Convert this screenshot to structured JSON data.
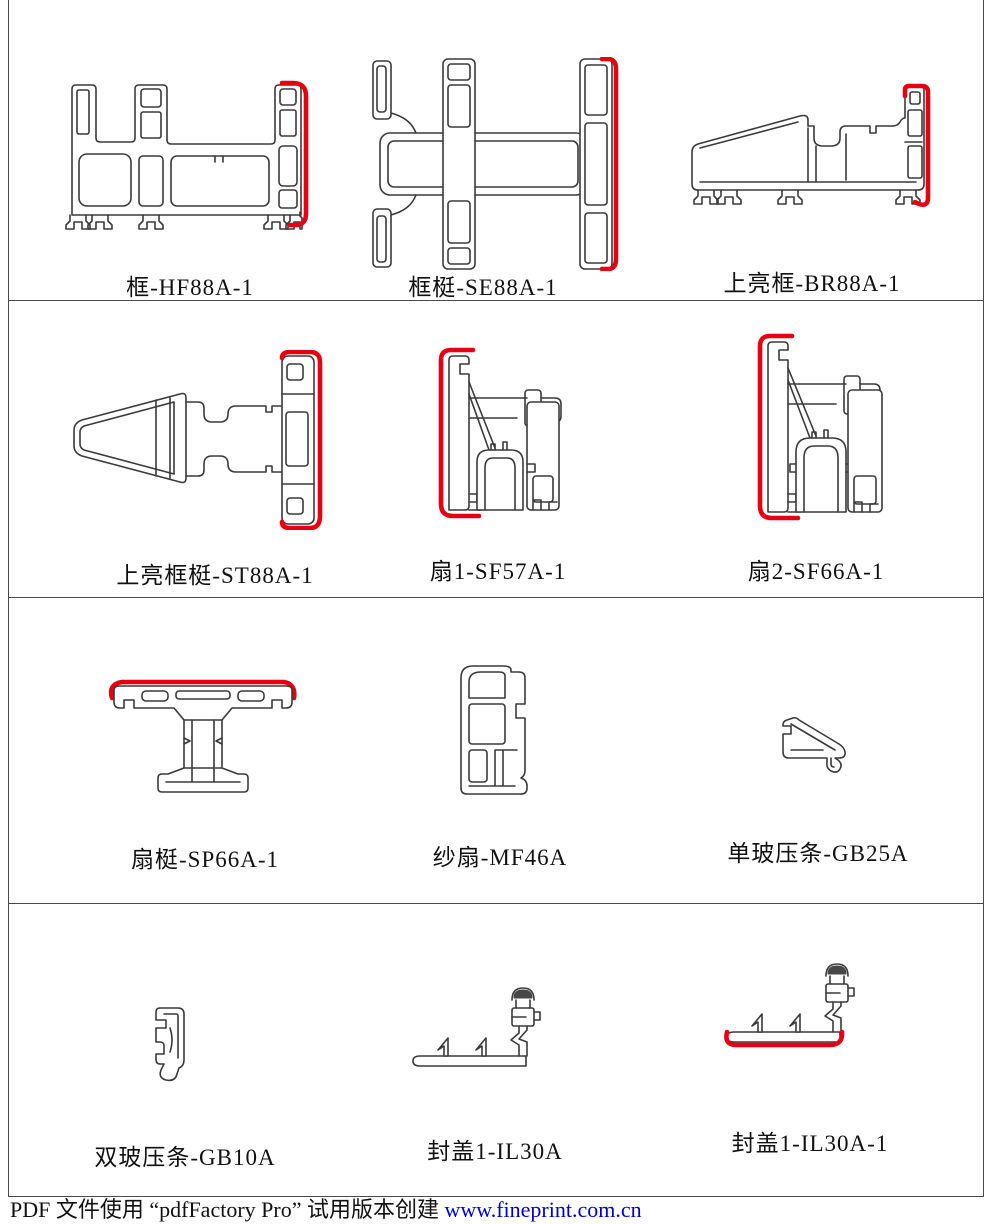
{
  "page": {
    "background": "#ffffff",
    "outline_color": "#3a3a3a",
    "highlight_color": "#e60012",
    "frame_color": "#4a4a4a",
    "link_color": "#0000cc"
  },
  "cells": [
    {
      "id": "hf88a-1",
      "label": "框-HF88A-1"
    },
    {
      "id": "se88a-1",
      "label": "框梃-SE88A-1"
    },
    {
      "id": "br88a-1",
      "label": "上亮框-BR88A-1"
    },
    {
      "id": "st88a-1",
      "label": "上亮框梃-ST88A-1"
    },
    {
      "id": "sf57a-1",
      "label": "扇1-SF57A-1"
    },
    {
      "id": "sf66a-1",
      "label": "扇2-SF66A-1"
    },
    {
      "id": "sp66a-1",
      "label": "扇梃-SP66A-1"
    },
    {
      "id": "mf46a",
      "label": "纱扇-MF46A"
    },
    {
      "id": "gb25a",
      "label": "单玻压条-GB25A"
    },
    {
      "id": "gb10a",
      "label": "双玻压条-GB10A"
    },
    {
      "id": "il30a",
      "label": "封盖1-IL30A"
    },
    {
      "id": "il30a-1",
      "label": "封盖1-IL30A-1"
    }
  ],
  "footer": {
    "watermark_text": "PDF 文件使用 “pdfFactory Pro” 试用版本创建 ",
    "watermark_link": "www.fineprint.com.cn"
  }
}
